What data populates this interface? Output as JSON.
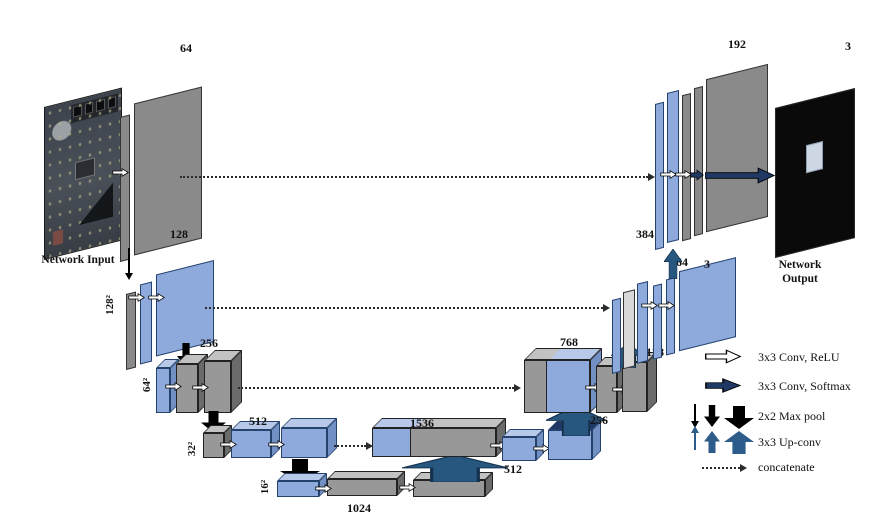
{
  "captions": {
    "input": "Network Input",
    "output": "Network Output"
  },
  "labels": {
    "enc1": "64",
    "enc2": "128",
    "enc3": "256",
    "enc4": "512",
    "bottleneck": "1024",
    "dec4_concat": "1536",
    "dec4_up": "512",
    "dec3_concat": "768",
    "dec3_up": "256",
    "dec2_concat": "384",
    "dec2_up": "128",
    "dec2_conv": "64",
    "dec2_out": "3",
    "dec1_concat": "192",
    "out_channels": "3"
  },
  "sizes": {
    "row2": "128²",
    "row3": "64²",
    "row4": "32²",
    "row5": "16²"
  },
  "legend": {
    "items": [
      {
        "name": "conv-relu",
        "label": "3x3 Conv, ReLU"
      },
      {
        "name": "conv-softmax",
        "label": "3x3 Conv, Softmax"
      },
      {
        "name": "max-pool",
        "label": "2x2 Max pool"
      },
      {
        "name": "up-conv",
        "label": "3x3 Up-conv"
      },
      {
        "name": "concatenate",
        "label": "concatenate"
      }
    ]
  },
  "colors": {
    "feature_blue": "#8ea9db",
    "feature_gray": "#8c8c8c",
    "concat_gray": "#d8d8d8",
    "arrow_softmax_navy": "#1f3864",
    "arrow_upconv_steel": "#2e5c8a",
    "arrow_maxpool_black": "#000000",
    "output_bg": "#0a0a0a"
  }
}
